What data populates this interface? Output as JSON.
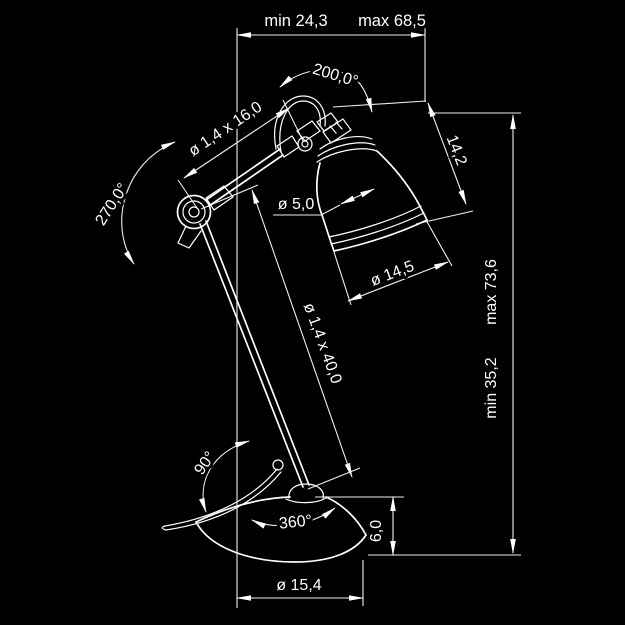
{
  "title": "Desk lamp technical dimension drawing",
  "canvas": {
    "background": "#000000",
    "line_color": "#ffffff"
  },
  "dims": {
    "top_span": {
      "min": "min 24,3",
      "max": "max 68,5"
    },
    "head_rotation": "200,0°",
    "upper_arm": "ø 1,4 x 16,0",
    "elbow_rotation": "270,0°",
    "head_length": "14,2",
    "shade_neck_diameter": "ø 5,0",
    "shade_mouth_diameter": "ø 14,5",
    "height_span": {
      "min": "min 35,2",
      "max": "max 73,6"
    },
    "lower_arm": "ø 1,4 x 40,0",
    "base_swivel": "90°",
    "base_rotation": "360°",
    "base_height": "6,0",
    "base_diameter": "ø 15,4"
  }
}
